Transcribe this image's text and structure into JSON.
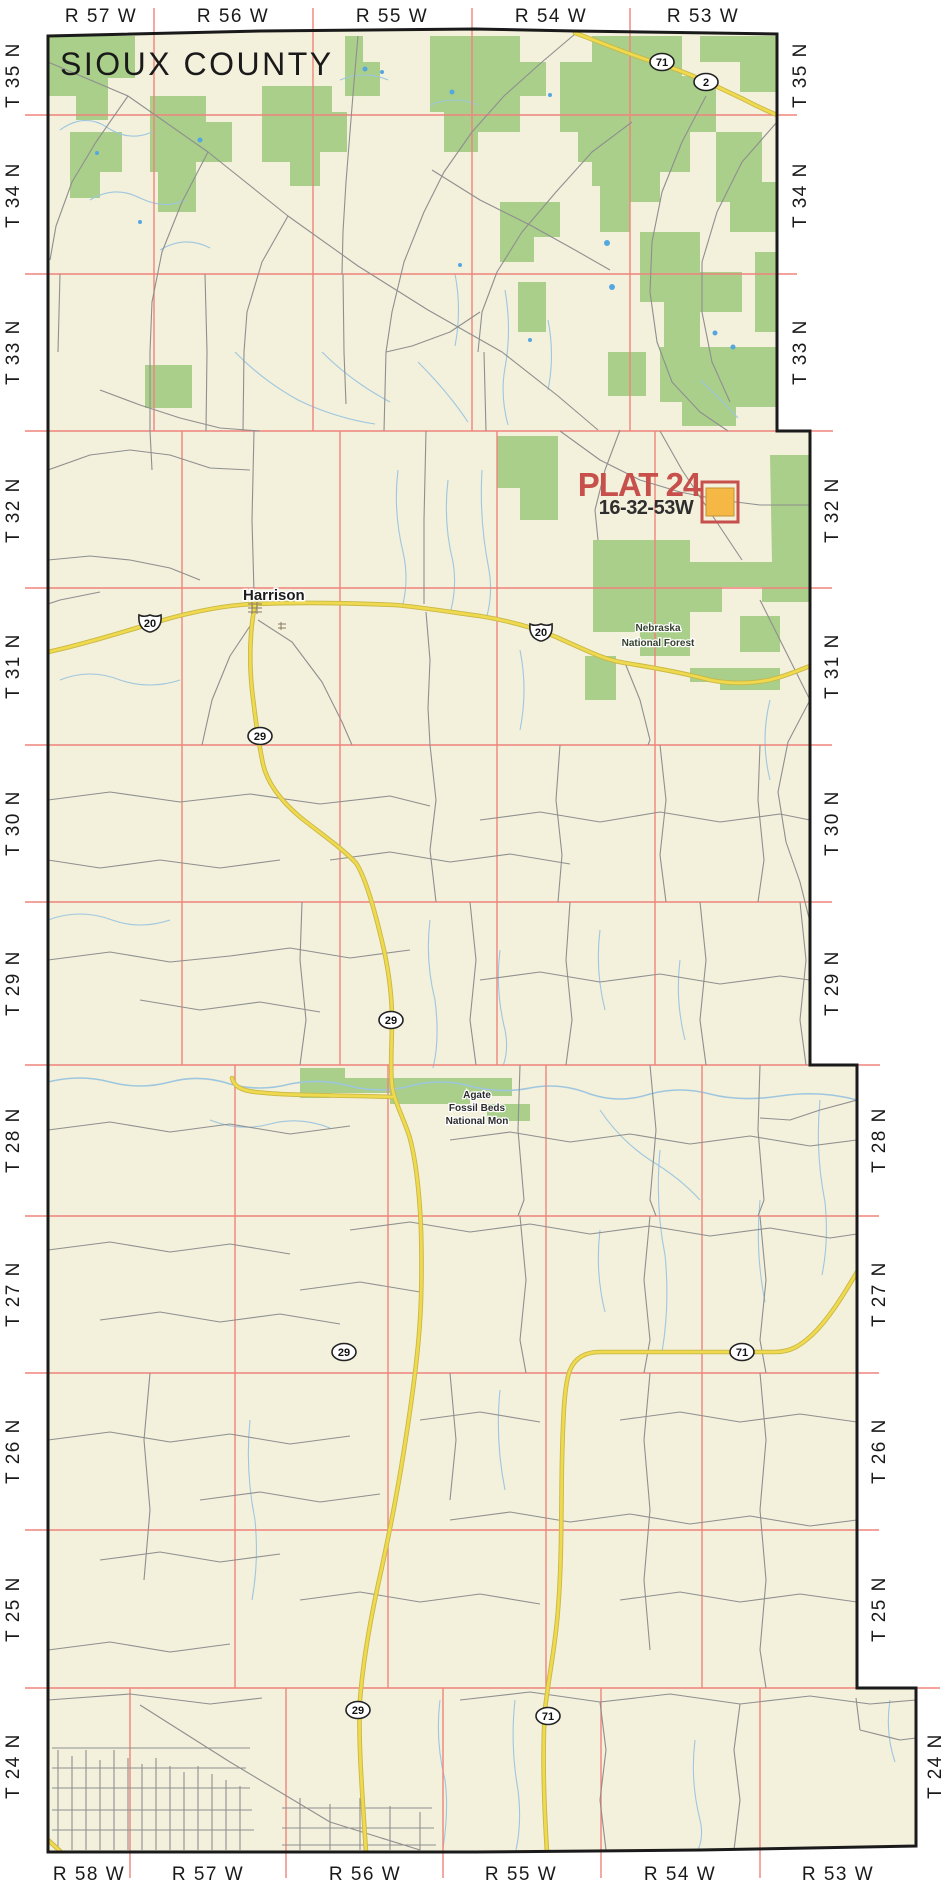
{
  "header": {
    "county_title": "SIOUX COUNTY"
  },
  "plat_marker": {
    "title": "PLAT 24",
    "code": "16-32-53W"
  },
  "grid": {
    "township_labels": [
      "T 35 N",
      "T 34 N",
      "T 33 N",
      "T 32 N",
      "T 31 N",
      "T 30 N",
      "T 29 N",
      "T 28 N",
      "T 27 N",
      "T 26 N",
      "T 25 N",
      "T 24 N"
    ],
    "range_labels_top": [
      "R 57 W",
      "R 56 W",
      "R 55 W",
      "R 54 W",
      "R 53 W"
    ],
    "range_labels_bottom": [
      "R 58 W",
      "R 57 W",
      "R 56 W",
      "R 55 W",
      "R 54 W",
      "R 53 W"
    ]
  },
  "places": {
    "town": "Harrison",
    "forest_line1": "Nebraska",
    "forest_line2": "National Forest",
    "monument_line1": "Agate",
    "monument_line2": "Fossil Beds",
    "monument_line3": "National Mon"
  },
  "highway_shields": [
    {
      "type": "oval",
      "number": "71"
    },
    {
      "type": "oval",
      "number": "2"
    },
    {
      "type": "us",
      "number": "20"
    },
    {
      "type": "us",
      "number": "20"
    },
    {
      "type": "oval",
      "number": "29"
    },
    {
      "type": "oval",
      "number": "29"
    },
    {
      "type": "oval",
      "number": "29"
    },
    {
      "type": "oval",
      "number": "71"
    },
    {
      "type": "oval",
      "number": "29"
    },
    {
      "type": "oval",
      "number": "71"
    }
  ],
  "colors": {
    "land": "#f3f0dc",
    "forest": "#a9cf8a",
    "grid": "#f0837c",
    "stream": "#9ec7df",
    "pond": "#55a7e2",
    "road": "#8f8f8f",
    "highway": "#efd94f",
    "highway_casing": "#c9b845",
    "border": "#1a1a1a",
    "label": "#1a1a1a",
    "plat_red": "#c7504c",
    "plat_code": "#2e2e2e",
    "plat_orange": "#f5b845",
    "forest_label": "#33402b",
    "monument_label": "#2b2b2b"
  }
}
